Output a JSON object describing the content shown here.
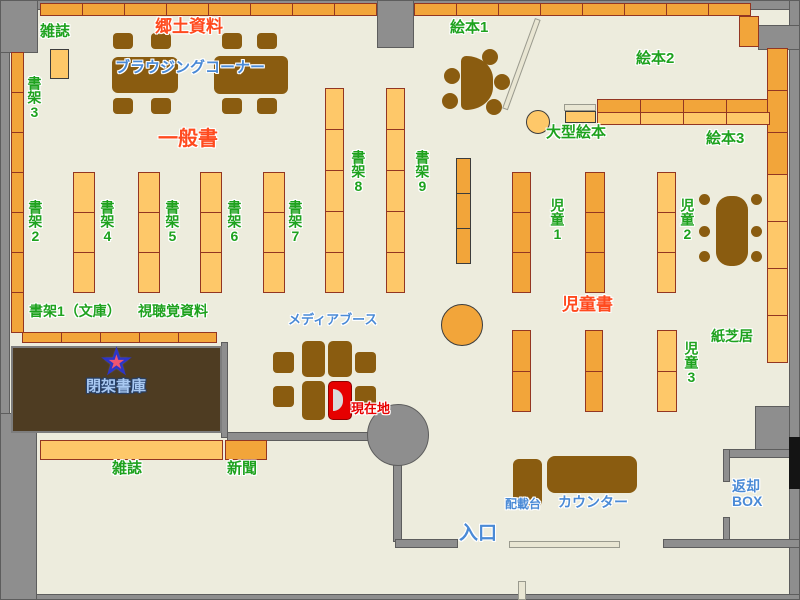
{
  "labels": {
    "magazines_top": "雑誌",
    "local_materials": "郷土資料",
    "browsing_corner": "ブラウジングコーナー",
    "shelf3": "書架3",
    "general_books": "一般書",
    "shelf2": "書架2",
    "shelf4": "書架4",
    "shelf5": "書架5",
    "shelf6": "書架6",
    "shelf7": "書架7",
    "shelf8": "書架8",
    "shelf9": "書架9",
    "picture_books1": "絵本1",
    "picture_books2": "絵本2",
    "picture_books3": "絵本3",
    "large_picture_books": "大型絵本",
    "children1": "児童1",
    "children2": "児童2",
    "children3": "児童3",
    "children_books": "児童書",
    "kamishibai": "紙芝居",
    "shelf1_bunko": "書架1（文庫）",
    "av_materials": "視聴覚資料",
    "closed_stacks": "閉架書庫",
    "media_booth": "メディアブース",
    "current_location": "現在地",
    "magazines_bottom": "雑誌",
    "newspaper": "新聞",
    "stand": "配載台",
    "counter": "カウンター",
    "return_box": "返却\nBOX",
    "entrance": "入口"
  },
  "icons": {
    "star_glyph": "★"
  },
  "colors": {
    "floor": "#edecdd",
    "wall": "#8e8e8e",
    "wallb": "#5d5d5d",
    "sdark": "#f2a53a",
    "slight": "#fec869",
    "sbr": "#933622",
    "furn": "#8a5c10",
    "stacks": "#4e3c22",
    "boothred": "#e60000",
    "door": "#e9e6d3",
    "green": "#1ea21e",
    "red": "#ff4a1e",
    "blue": "#4a8ad6",
    "lightblue": "#a9c9f2",
    "currentred": "#e80000",
    "starred": "#ef5570",
    "starblue": "#2d35c8"
  }
}
